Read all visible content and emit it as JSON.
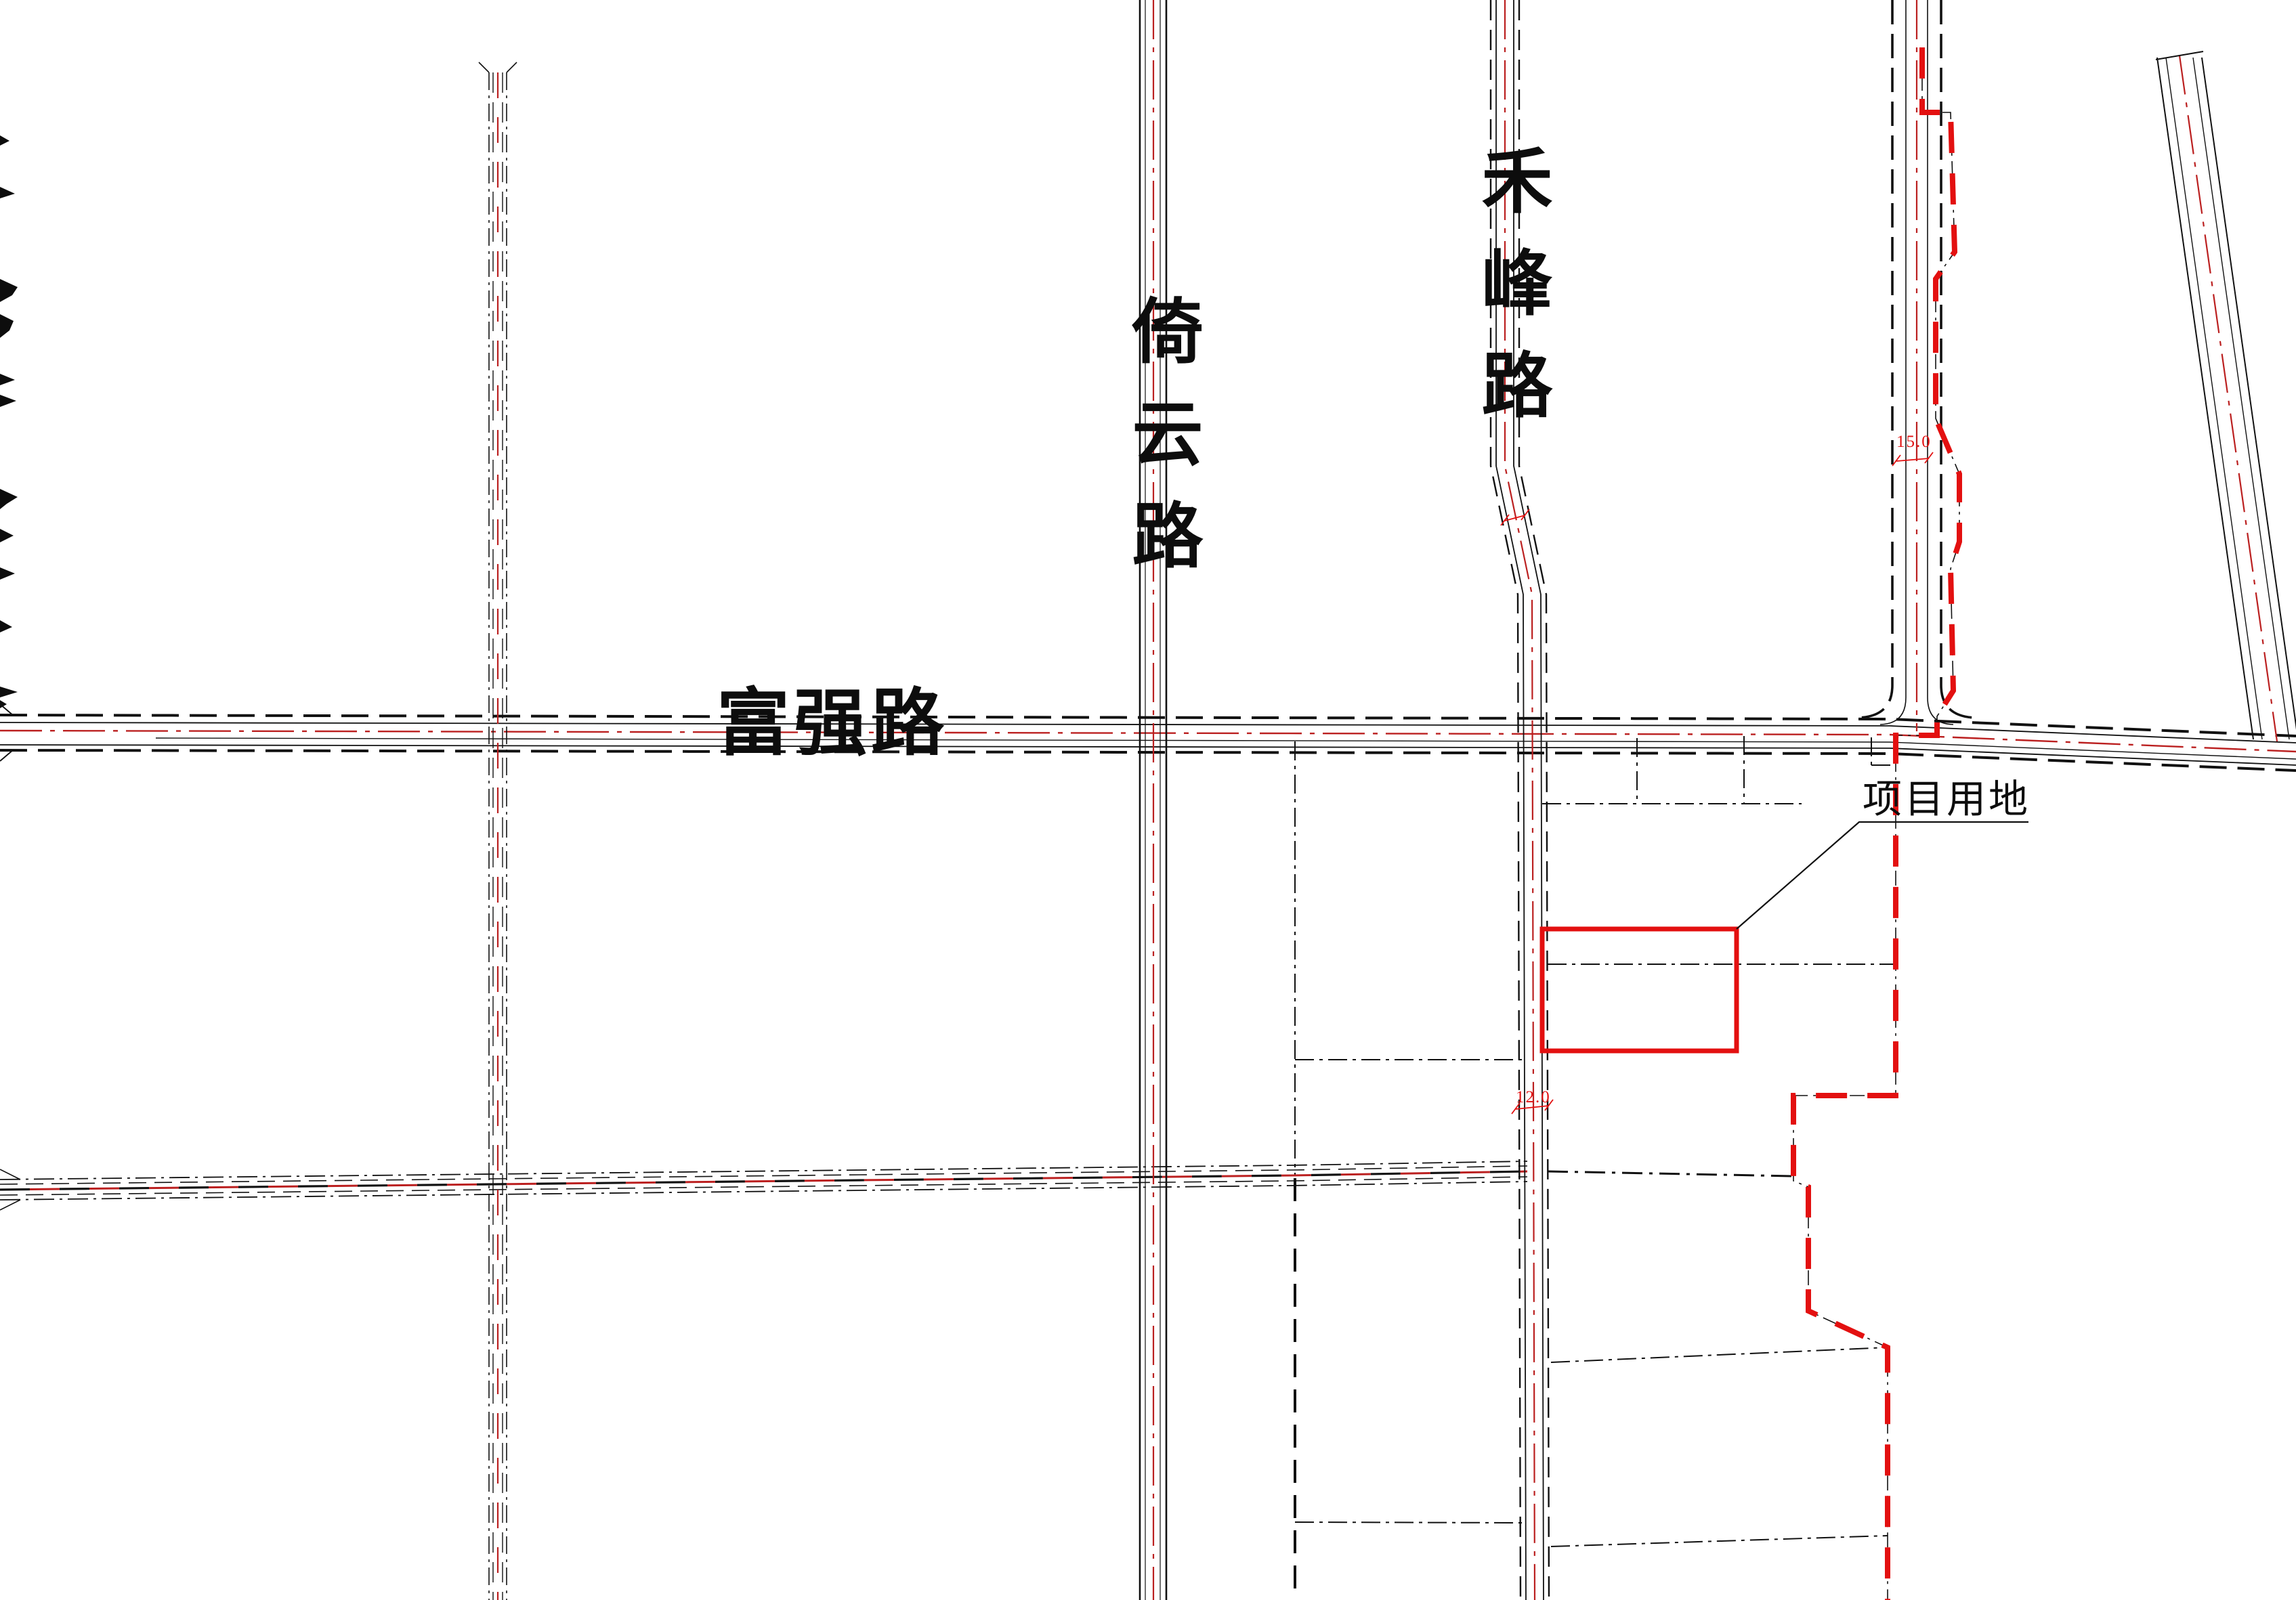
{
  "page": {
    "background": "#ffffff",
    "drawing_type": "site-location-plan"
  },
  "colors": {
    "line_black": "#111111",
    "centerline_red": "#bb2020",
    "boundary_red": "#e31010"
  },
  "labels": {
    "road_horizontal_main": "富强路",
    "road_vertical_west": "倚云路",
    "road_vertical_east": "禾峰路",
    "site": "项目用地",
    "dim_east_road_width": "15.0",
    "dim_hefeng_road_width": "12.0"
  }
}
